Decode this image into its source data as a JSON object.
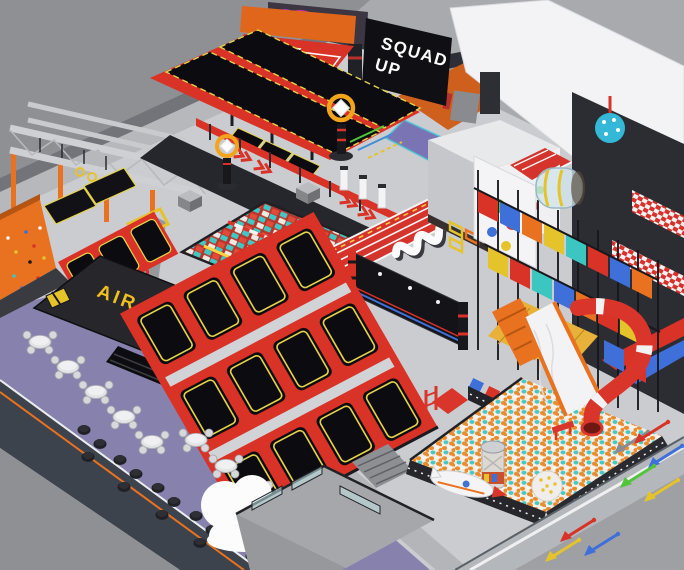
{
  "scene": {
    "subject": "Indoor trampoline park - isometric 3D render",
    "signs": {
      "banner_line1": "SQUAD",
      "banner_line2": "UP",
      "air_bag_label": "AIR BAG"
    },
    "palette": {
      "frame_red": "#d93227",
      "orange": "#e8721f",
      "trim_yellow": "#e3d24b",
      "gold_text": "#f0c01f",
      "mat_black": "#0c0c10",
      "foam_cyan": "#3cc6c2",
      "cafe_purple": "#8781ae",
      "floor_gray": "#cbccd0",
      "wall_gray": "#8f9094",
      "roof_white": "#f3f3f5",
      "ballpit_orange": "#ea8c2e",
      "blue": "#3f6fd8",
      "ring_orange": "#f2a41c"
    },
    "regions": [
      "ninja-course",
      "basketball-dunk-lanes",
      "climbing-wall",
      "dodgeball-court",
      "tumbling-lanes",
      "entrance-gates",
      "foam-cube-pit",
      "ring-target",
      "running-track",
      "interactive-wall",
      "wall-trampolines",
      "air-bag-pit",
      "main-trampoline-courts",
      "cafe-seating",
      "cloud-sculpture",
      "ball-pit",
      "rocket-sculpture",
      "soft-play-structure",
      "spiral-tube-slide",
      "wave-slide",
      "squad-up-banner",
      "graffiti-wall",
      "floor-arrows"
    ]
  }
}
